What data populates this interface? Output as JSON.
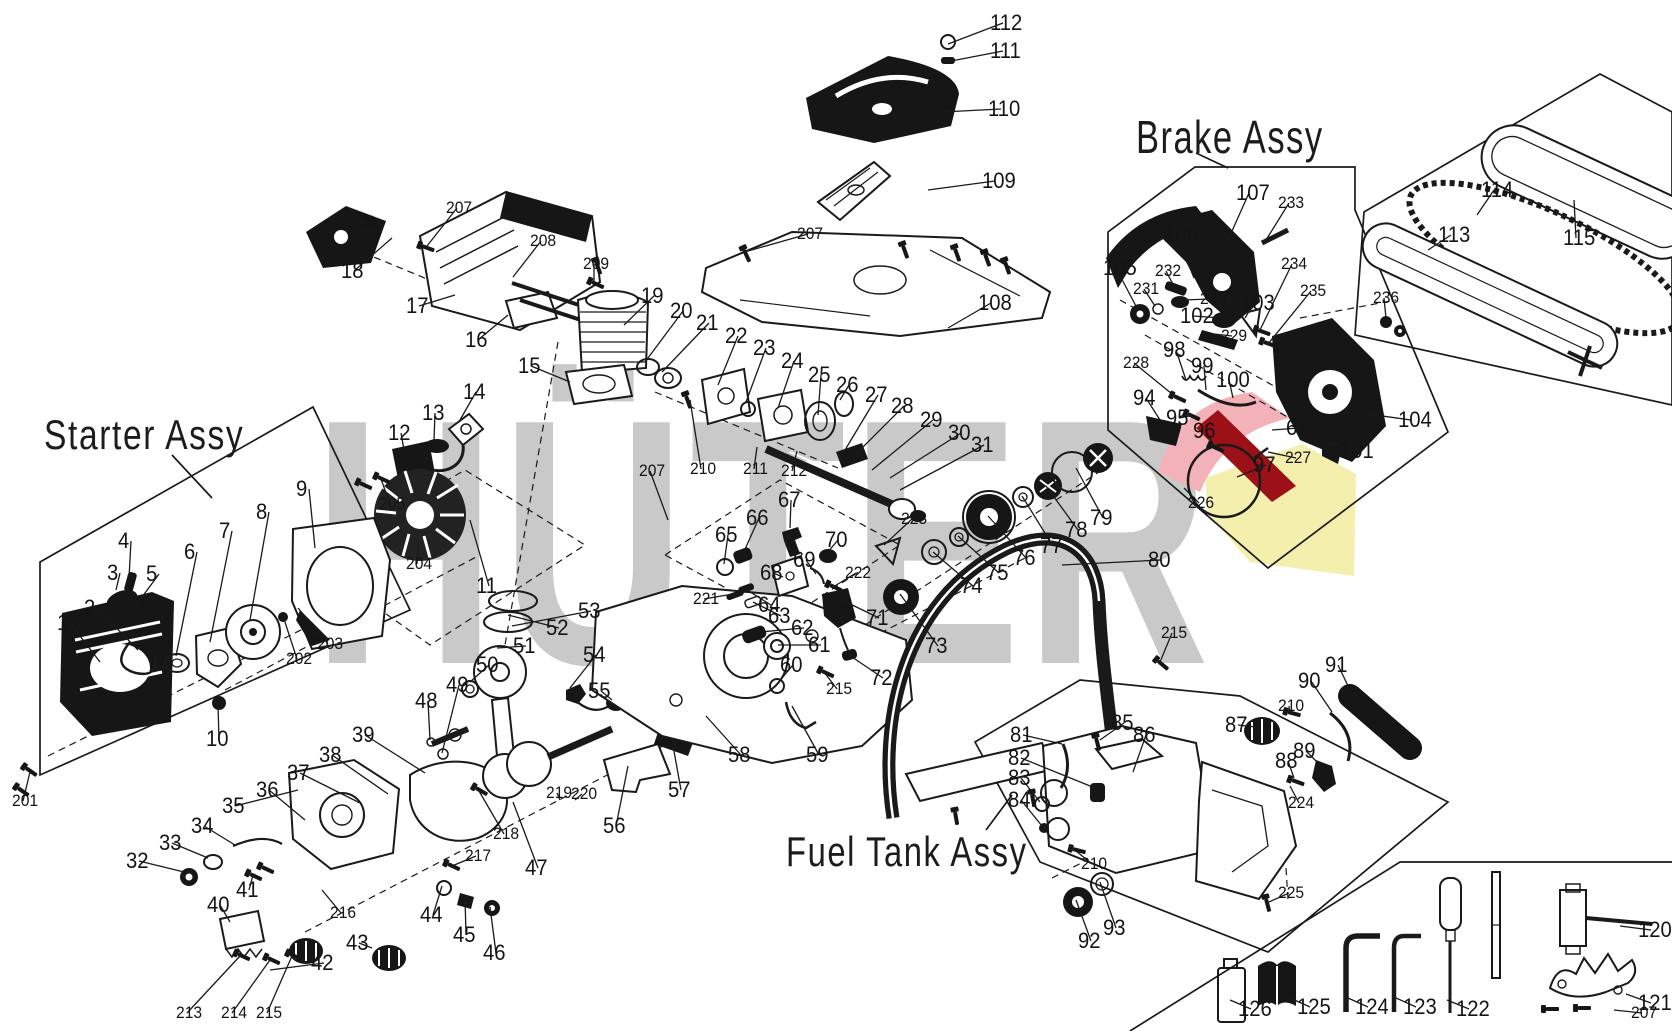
{
  "watermark": {
    "text": "HÜTER",
    "colors": {
      "gray": "#c9c9c9",
      "pink": "#f3b2b7",
      "red": "#9c1118",
      "yellow": "#f5efad"
    }
  },
  "titles": {
    "starter": "Starter Assy",
    "brake": "Brake Assy",
    "fuel": "Fuel Tank Assy"
  },
  "parts": [
    {
      "n": "1",
      "x": 57,
      "y": 612,
      "t": [
        100,
        662
      ]
    },
    {
      "n": "2",
      "x": 84,
      "y": 597,
      "t": [
        138,
        650
      ]
    },
    {
      "n": "3",
      "x": 107,
      "y": 562,
      "t": [
        116,
        590
      ]
    },
    {
      "n": "4",
      "x": 118,
      "y": 530,
      "t": [
        129,
        578
      ]
    },
    {
      "n": "5",
      "x": 146,
      "y": 563,
      "t": [
        134,
        608
      ]
    },
    {
      "n": "6",
      "x": 184,
      "y": 541,
      "t": [
        176,
        656
      ]
    },
    {
      "n": "7",
      "x": 219,
      "y": 520,
      "t": [
        210,
        642
      ]
    },
    {
      "n": "8",
      "x": 256,
      "y": 501,
      "t": [
        250,
        620
      ]
    },
    {
      "n": "9",
      "x": 296,
      "y": 478,
      "t": [
        315,
        548
      ]
    },
    {
      "n": "10",
      "x": 206,
      "y": 728,
      "t": [
        218,
        706
      ]
    },
    {
      "n": "11",
      "x": 476,
      "y": 575,
      "t": [
        470,
        520
      ]
    },
    {
      "n": "12",
      "x": 388,
      "y": 422,
      "t": [
        404,
        450
      ]
    },
    {
      "n": "13",
      "x": 422,
      "y": 402,
      "t": [
        434,
        440
      ]
    },
    {
      "n": "14",
      "x": 463,
      "y": 381,
      "t": [
        460,
        420
      ]
    },
    {
      "n": "15",
      "x": 518,
      "y": 355,
      "t": [
        570,
        382
      ]
    },
    {
      "n": "16",
      "x": 465,
      "y": 329,
      "t": [
        508,
        315
      ]
    },
    {
      "n": "17",
      "x": 406,
      "y": 295,
      "t": [
        455,
        295
      ]
    },
    {
      "n": "18",
      "x": 341,
      "y": 260,
      "t": [
        392,
        238
      ]
    },
    {
      "n": "19",
      "x": 641,
      "y": 285,
      "t": [
        624,
        325
      ]
    },
    {
      "n": "20",
      "x": 670,
      "y": 300,
      "t": [
        645,
        362
      ]
    },
    {
      "n": "21",
      "x": 696,
      "y": 312,
      "t": [
        662,
        372
      ]
    },
    {
      "n": "22",
      "x": 725,
      "y": 325,
      "t": [
        718,
        385
      ]
    },
    {
      "n": "23",
      "x": 753,
      "y": 337,
      "t": [
        746,
        402
      ]
    },
    {
      "n": "24",
      "x": 781,
      "y": 350,
      "t": [
        778,
        408
      ]
    },
    {
      "n": "25",
      "x": 808,
      "y": 364,
      "t": [
        818,
        415
      ]
    },
    {
      "n": "26",
      "x": 836,
      "y": 374,
      "t": [
        840,
        400
      ]
    },
    {
      "n": "27",
      "x": 865,
      "y": 384,
      "t": [
        845,
        450
      ]
    },
    {
      "n": "28",
      "x": 891,
      "y": 395,
      "t": [
        852,
        458
      ]
    },
    {
      "n": "29",
      "x": 920,
      "y": 409,
      "t": [
        872,
        470
      ]
    },
    {
      "n": "30",
      "x": 948,
      "y": 422,
      "t": [
        890,
        478
      ]
    },
    {
      "n": "31",
      "x": 971,
      "y": 434,
      "t": [
        900,
        490
      ]
    },
    {
      "n": "32",
      "x": 126,
      "y": 850,
      "t": [
        184,
        872
      ]
    },
    {
      "n": "33",
      "x": 159,
      "y": 832,
      "t": [
        208,
        858
      ]
    },
    {
      "n": "34",
      "x": 191,
      "y": 815,
      "t": [
        235,
        845
      ]
    },
    {
      "n": "35",
      "x": 222,
      "y": 795,
      "t": [
        298,
        790
      ]
    },
    {
      "n": "36",
      "x": 256,
      "y": 779,
      "t": [
        305,
        820
      ]
    },
    {
      "n": "37",
      "x": 287,
      "y": 762,
      "t": [
        360,
        803
      ]
    },
    {
      "n": "38",
      "x": 319,
      "y": 744,
      "t": [
        388,
        794
      ]
    },
    {
      "n": "39",
      "x": 352,
      "y": 724,
      "t": [
        425,
        773
      ]
    },
    {
      "n": "40",
      "x": 207,
      "y": 894,
      "t": [
        230,
        922
      ]
    },
    {
      "n": "41",
      "x": 236,
      "y": 879,
      "t": [
        253,
        875
      ]
    },
    {
      "n": "42",
      "x": 311,
      "y": 952,
      "t": [
        270,
        970
      ]
    },
    {
      "n": "43",
      "x": 346,
      "y": 932,
      "t": [
        372,
        948
      ]
    },
    {
      "n": "44",
      "x": 420,
      "y": 904,
      "t": [
        442,
        886
      ]
    },
    {
      "n": "45",
      "x": 453,
      "y": 924,
      "t": [
        465,
        897
      ]
    },
    {
      "n": "46",
      "x": 483,
      "y": 942,
      "t": [
        490,
        907
      ]
    },
    {
      "n": "47",
      "x": 525,
      "y": 857,
      "t": [
        513,
        802
      ]
    },
    {
      "n": "48",
      "x": 415,
      "y": 690,
      "t": [
        430,
        740
      ]
    },
    {
      "n": "49",
      "x": 446,
      "y": 674,
      "t": [
        442,
        753
      ]
    },
    {
      "n": "50",
      "x": 476,
      "y": 654,
      "t": [
        470,
        682
      ]
    },
    {
      "n": "51",
      "x": 513,
      "y": 635,
      "t": [
        497,
        648
      ]
    },
    {
      "n": "52",
      "x": 546,
      "y": 617,
      "t": [
        508,
        615
      ]
    },
    {
      "n": "53",
      "x": 578,
      "y": 600,
      "t": [
        512,
        626
      ]
    },
    {
      "n": "54",
      "x": 583,
      "y": 644,
      "t": [
        570,
        688
      ]
    },
    {
      "n": "55",
      "x": 588,
      "y": 680,
      "t": [
        612,
        700
      ]
    },
    {
      "n": "56",
      "x": 603,
      "y": 815,
      "t": [
        628,
        766
      ]
    },
    {
      "n": "57",
      "x": 668,
      "y": 779,
      "t": [
        672,
        740
      ]
    },
    {
      "n": "58",
      "x": 728,
      "y": 744,
      "t": [
        706,
        716
      ]
    },
    {
      "n": "59",
      "x": 806,
      "y": 744,
      "t": [
        792,
        706
      ]
    },
    {
      "n": "60",
      "x": 780,
      "y": 654,
      "t": [
        777,
        684
      ]
    },
    {
      "n": "61",
      "x": 808,
      "y": 634,
      "t": [
        778,
        645
      ]
    },
    {
      "n": "62",
      "x": 791,
      "y": 617,
      "t": [
        760,
        632
      ]
    },
    {
      "n": "62",
      "x": 1286,
      "y": 417,
      "t": [
        1272,
        430
      ]
    },
    {
      "n": "63",
      "x": 768,
      "y": 605,
      "t": [
        753,
        602
      ]
    },
    {
      "n": "64",
      "x": 758,
      "y": 594,
      "t": [
        747,
        590
      ]
    },
    {
      "n": "65",
      "x": 715,
      "y": 524,
      "t": [
        724,
        564
      ]
    },
    {
      "n": "66",
      "x": 746,
      "y": 507,
      "t": [
        742,
        556
      ]
    },
    {
      "n": "67",
      "x": 778,
      "y": 489,
      "t": [
        790,
        528
      ]
    },
    {
      "n": "68",
      "x": 760,
      "y": 562,
      "t": [
        783,
        577
      ]
    },
    {
      "n": "69",
      "x": 793,
      "y": 549,
      "t": [
        816,
        574
      ]
    },
    {
      "n": "70",
      "x": 825,
      "y": 529,
      "t": [
        827,
        553
      ]
    },
    {
      "n": "71",
      "x": 866,
      "y": 607,
      "t": [
        842,
        600
      ]
    },
    {
      "n": "72",
      "x": 870,
      "y": 667,
      "t": [
        849,
        655
      ]
    },
    {
      "n": "73",
      "x": 925,
      "y": 635,
      "t": [
        900,
        594
      ]
    },
    {
      "n": "74",
      "x": 960,
      "y": 575,
      "t": [
        933,
        552
      ]
    },
    {
      "n": "75",
      "x": 986,
      "y": 562,
      "t": [
        958,
        536
      ]
    },
    {
      "n": "76",
      "x": 1013,
      "y": 547,
      "t": [
        988,
        516
      ]
    },
    {
      "n": "77",
      "x": 1040,
      "y": 535,
      "t": [
        1022,
        496
      ]
    },
    {
      "n": "78",
      "x": 1065,
      "y": 519,
      "t": [
        1046,
        486
      ]
    },
    {
      "n": "79",
      "x": 1090,
      "y": 507,
      "t": [
        1076,
        468
      ]
    },
    {
      "n": "80",
      "x": 1148,
      "y": 549,
      "t": [
        1062,
        565
      ]
    },
    {
      "n": "81",
      "x": 1010,
      "y": 724,
      "t": [
        1062,
        744
      ]
    },
    {
      "n": "82",
      "x": 1008,
      "y": 747,
      "t": [
        1095,
        788
      ]
    },
    {
      "n": "83",
      "x": 1008,
      "y": 767,
      "t": [
        1040,
        802
      ]
    },
    {
      "n": "84",
      "x": 1008,
      "y": 789,
      "t": [
        1042,
        826
      ]
    },
    {
      "n": "85",
      "x": 1111,
      "y": 712,
      "t": [
        1100,
        740
      ]
    },
    {
      "n": "86",
      "x": 1133,
      "y": 724,
      "t": [
        1133,
        772
      ]
    },
    {
      "n": "87",
      "x": 1225,
      "y": 714,
      "t": [
        1256,
        727
      ]
    },
    {
      "n": "88",
      "x": 1275,
      "y": 750,
      "t": [
        1294,
        778
      ]
    },
    {
      "n": "89",
      "x": 1293,
      "y": 740,
      "t": [
        1318,
        763
      ]
    },
    {
      "n": "90",
      "x": 1298,
      "y": 670,
      "t": [
        1332,
        712
      ]
    },
    {
      "n": "91",
      "x": 1325,
      "y": 654,
      "t": [
        1350,
        690
      ]
    },
    {
      "n": "92",
      "x": 1078,
      "y": 930,
      "t": [
        1076,
        900
      ]
    },
    {
      "n": "93",
      "x": 1103,
      "y": 917,
      "t": [
        1100,
        882
      ]
    },
    {
      "n": "94",
      "x": 1133,
      "y": 387,
      "t": [
        1160,
        420
      ]
    },
    {
      "n": "95",
      "x": 1166,
      "y": 407,
      "t": [
        1190,
        416
      ]
    },
    {
      "n": "96",
      "x": 1193,
      "y": 420,
      "t": [
        1215,
        448
      ]
    },
    {
      "n": "97",
      "x": 1253,
      "y": 454,
      "t": [
        1237,
        477
      ]
    },
    {
      "n": "98",
      "x": 1163,
      "y": 339,
      "t": [
        1186,
        380
      ]
    },
    {
      "n": "99",
      "x": 1191,
      "y": 355,
      "t": [
        1206,
        390
      ]
    },
    {
      "n": "100",
      "x": 1216,
      "y": 369,
      "t": [
        1233,
        398
      ]
    },
    {
      "n": "101",
      "x": 1340,
      "y": 440,
      "t": [
        1327,
        442
      ]
    },
    {
      "n": "102",
      "x": 1180,
      "y": 305,
      "t": [
        1222,
        318
      ]
    },
    {
      "n": "103",
      "x": 1241,
      "y": 292,
      "t": [
        1245,
        318
      ]
    },
    {
      "n": "104",
      "x": 1398,
      "y": 409,
      "t": [
        1368,
        414
      ]
    },
    {
      "n": "105",
      "x": 1103,
      "y": 257,
      "t": [
        1138,
        310
      ]
    },
    {
      "n": "106",
      "x": 1164,
      "y": 224,
      "t": [
        1194,
        278
      ]
    },
    {
      "n": "107",
      "x": 1236,
      "y": 182,
      "t": [
        1228,
        240
      ]
    },
    {
      "n": "108",
      "x": 978,
      "y": 292,
      "t": [
        948,
        328
      ]
    },
    {
      "n": "109",
      "x": 982,
      "y": 170,
      "t": [
        928,
        190
      ]
    },
    {
      "n": "110",
      "x": 988,
      "y": 98,
      "t": [
        942,
        112
      ]
    },
    {
      "n": "111",
      "x": 990,
      "y": 40,
      "t": [
        946,
        62
      ]
    },
    {
      "n": "112",
      "x": 990,
      "y": 12,
      "t": [
        948,
        44
      ]
    },
    {
      "n": "113",
      "x": 1438,
      "y": 224,
      "t": [
        1428,
        250
      ]
    },
    {
      "n": "114",
      "x": 1481,
      "y": 179,
      "t": [
        1477,
        215
      ]
    },
    {
      "n": "115",
      "x": 1563,
      "y": 227,
      "t": [
        1574,
        200
      ]
    },
    {
      "n": "120",
      "x": 1638,
      "y": 919,
      "t": [
        1620,
        926
      ]
    },
    {
      "n": "121",
      "x": 1638,
      "y": 992,
      "t": [
        1626,
        994
      ]
    },
    {
      "n": "122",
      "x": 1456,
      "y": 998,
      "t": [
        1447,
        1000
      ]
    },
    {
      "n": "123",
      "x": 1403,
      "y": 996,
      "t": [
        1396,
        998
      ]
    },
    {
      "n": "124",
      "x": 1355,
      "y": 996,
      "t": [
        1348,
        998
      ]
    },
    {
      "n": "125",
      "x": 1297,
      "y": 996,
      "t": [
        1290,
        998
      ]
    },
    {
      "n": "126",
      "x": 1238,
      "y": 998,
      "t": [
        1230,
        1000
      ]
    },
    {
      "n": "201",
      "x": 12,
      "y": 792,
      "t": [
        30,
        772
      ]
    },
    {
      "n": "202",
      "x": 286,
      "y": 650,
      "t": [
        283,
        616
      ]
    },
    {
      "n": "203",
      "x": 317,
      "y": 635,
      "t": [
        298,
        608
      ]
    },
    {
      "n": "204",
      "x": 406,
      "y": 555,
      "t": [
        418,
        543
      ]
    },
    {
      "n": "205",
      "x": 379,
      "y": 495,
      "t": [
        381,
        479
      ]
    },
    {
      "n": "206",
      "x": 349,
      "y": 213,
      "t": [
        370,
        222
      ]
    },
    {
      "n": "207",
      "x": 797,
      "y": 225,
      "t": [
        748,
        251
      ]
    },
    {
      "n": "207",
      "x": 446,
      "y": 199,
      "t": [
        427,
        246
      ]
    },
    {
      "n": "207",
      "x": 639,
      "y": 462,
      "t": [
        668,
        520
      ]
    },
    {
      "n": "207",
      "x": 1631,
      "y": 1004,
      "t": [
        1614,
        1010
      ]
    },
    {
      "n": "208",
      "x": 530,
      "y": 232,
      "t": [
        513,
        277
      ]
    },
    {
      "n": "209",
      "x": 583,
      "y": 255,
      "t": [
        594,
        284
      ]
    },
    {
      "n": "210",
      "x": 690,
      "y": 460,
      "t": [
        690,
        400
      ]
    },
    {
      "n": "210",
      "x": 1278,
      "y": 697,
      "t": [
        1290,
        713
      ]
    },
    {
      "n": "210",
      "x": 1081,
      "y": 855,
      "t": [
        1076,
        851
      ]
    },
    {
      "n": "211",
      "x": 743,
      "y": 460,
      "t": [
        757,
        447
      ]
    },
    {
      "n": "212",
      "x": 781,
      "y": 462,
      "t": [
        797,
        451
      ]
    },
    {
      "n": "213",
      "x": 176,
      "y": 1004,
      "t": [
        240,
        956
      ]
    },
    {
      "n": "214",
      "x": 221,
      "y": 1004,
      "t": [
        270,
        960
      ]
    },
    {
      "n": "215",
      "x": 256,
      "y": 1004,
      "t": [
        292,
        956
      ]
    },
    {
      "n": "215",
      "x": 826,
      "y": 680,
      "t": [
        824,
        672
      ]
    },
    {
      "n": "215",
      "x": 1161,
      "y": 624,
      "t": [
        1160,
        662
      ]
    },
    {
      "n": "216",
      "x": 330,
      "y": 904,
      "t": [
        322,
        890
      ]
    },
    {
      "n": "217",
      "x": 465,
      "y": 847,
      "t": [
        452,
        866
      ]
    },
    {
      "n": "218",
      "x": 493,
      "y": 825,
      "t": [
        479,
        791
      ]
    },
    {
      "n": "219",
      "x": 546,
      "y": 784,
      "t": [
        560,
        800
      ]
    },
    {
      "n": "220",
      "x": 571,
      "y": 785,
      "t": [
        575,
        800
      ]
    },
    {
      "n": "221",
      "x": 693,
      "y": 590,
      "t": [
        733,
        594
      ]
    },
    {
      "n": "222",
      "x": 845,
      "y": 564,
      "t": [
        833,
        587
      ]
    },
    {
      "n": "223",
      "x": 901,
      "y": 510,
      "t": [
        884,
        545
      ]
    },
    {
      "n": "224",
      "x": 1288,
      "y": 794,
      "t": [
        1290,
        786
      ]
    },
    {
      "n": "225",
      "x": 1278,
      "y": 884,
      "t": [
        1269,
        902
      ]
    },
    {
      "n": "226",
      "x": 1188,
      "y": 494,
      "t": [
        1184,
        488
      ]
    },
    {
      "n": "227",
      "x": 1285,
      "y": 449,
      "t": [
        1268,
        452
      ]
    },
    {
      "n": "228",
      "x": 1123,
      "y": 354,
      "t": [
        1177,
        398
      ]
    },
    {
      "n": "229",
      "x": 1221,
      "y": 327,
      "t": [
        1214,
        334
      ]
    },
    {
      "n": "230",
      "x": 1200,
      "y": 290,
      "t": [
        1182,
        300
      ]
    },
    {
      "n": "231",
      "x": 1133,
      "y": 280,
      "t": [
        1155,
        306
      ]
    },
    {
      "n": "232",
      "x": 1155,
      "y": 262,
      "t": [
        1176,
        290
      ]
    },
    {
      "n": "233",
      "x": 1278,
      "y": 194,
      "t": [
        1266,
        240
      ]
    },
    {
      "n": "234",
      "x": 1281,
      "y": 255,
      "t": [
        1260,
        330
      ]
    },
    {
      "n": "235",
      "x": 1300,
      "y": 282,
      "t": [
        1268,
        344
      ]
    },
    {
      "n": "236",
      "x": 1373,
      "y": 289,
      "t": [
        1386,
        318
      ]
    }
  ]
}
